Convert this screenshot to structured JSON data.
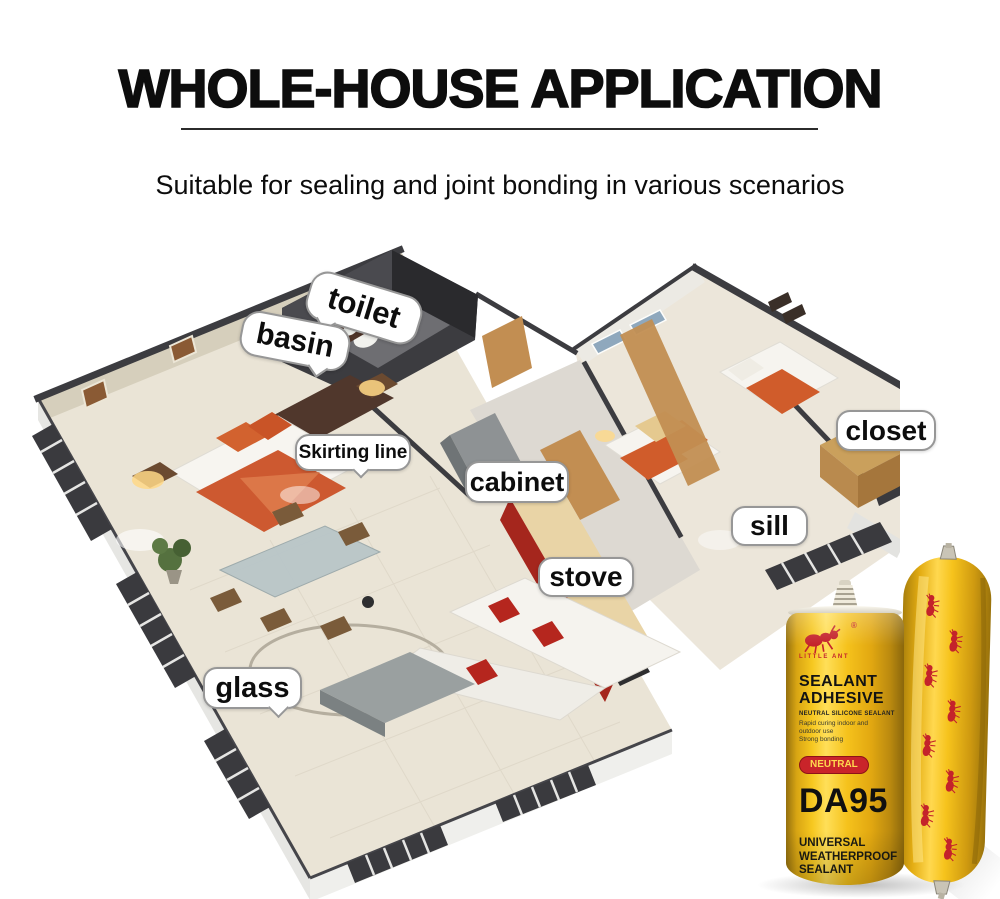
{
  "header": {
    "title": "WHOLE-HOUSE APPLICATION",
    "subtitle": "Suitable for sealing and joint bonding in various scenarios"
  },
  "floorplan": {
    "labels": {
      "toilet": "toilet",
      "basin": "basin",
      "skirting_line": "Skirting line",
      "cabinet": "cabinet",
      "closet": "closet",
      "sill": "sill",
      "stove": "stove",
      "glass": "glass"
    }
  },
  "product": {
    "brand": "LITTLE ANT",
    "registered_mark": "®",
    "name_line1": "SEALANT",
    "name_line2": "ADHESIVE",
    "type_line": "NEUTRAL SILICONE SEALANT",
    "features": [
      "Rapid curing indoor and",
      "outdoor use",
      "Strong bonding"
    ],
    "badge": "NEUTRAL",
    "model": "DA95",
    "category_lines": [
      "UNIVERSAL",
      "WEATHERPROOF",
      "SEALANT"
    ],
    "net_content": "NET: 300ml"
  },
  "icons": {
    "ant_logo": "ant-logo-icon",
    "registered": "registered-trademark-icon",
    "cert_circle": "certification-icon",
    "clover": "clover-icon"
  },
  "colors": {
    "accent_yellow": "#f2c01d",
    "brand_red": "#c9242a",
    "wall_dark": "#3c3c40",
    "floor_beige": "#eae4d6",
    "bed_orange": "#cd5930",
    "wood": "#c28e52"
  }
}
